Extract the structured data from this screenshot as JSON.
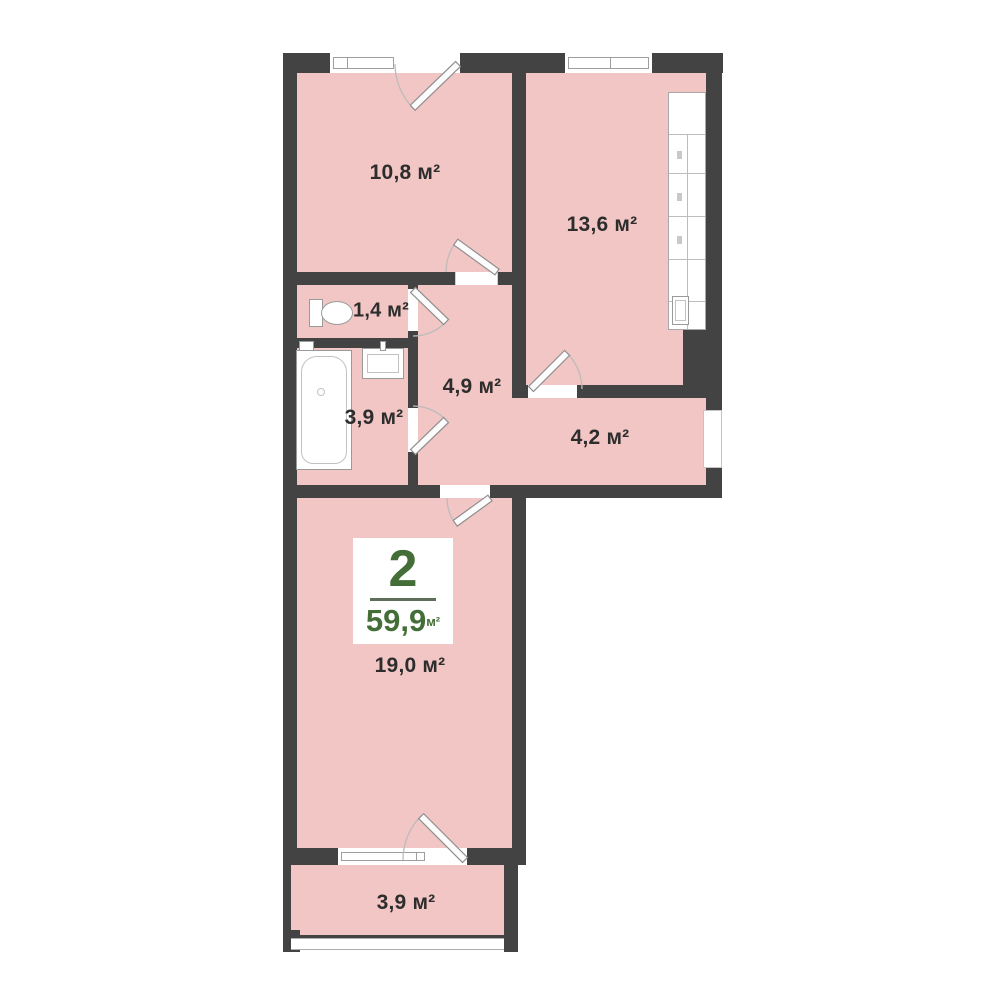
{
  "plan": {
    "badge": {
      "room_count": "2",
      "total_area": "59,9",
      "area_unit": "м²"
    },
    "labels": {
      "room_top_left": "10,8 м²",
      "kitchen": "13,6 м²",
      "wc": "1,4 м²",
      "hall": "4,9 м²",
      "bathroom": "3,9 м²",
      "corridor": "4,2 м²",
      "living": "19,0 м²",
      "balcony": "3,9 м²"
    },
    "colors": {
      "wall": "#434343",
      "room_fill": "#f2c6c4",
      "accent_green": "#446e38",
      "label_text": "#2d2d2d",
      "fixture_line": "#9a9a9a"
    }
  }
}
